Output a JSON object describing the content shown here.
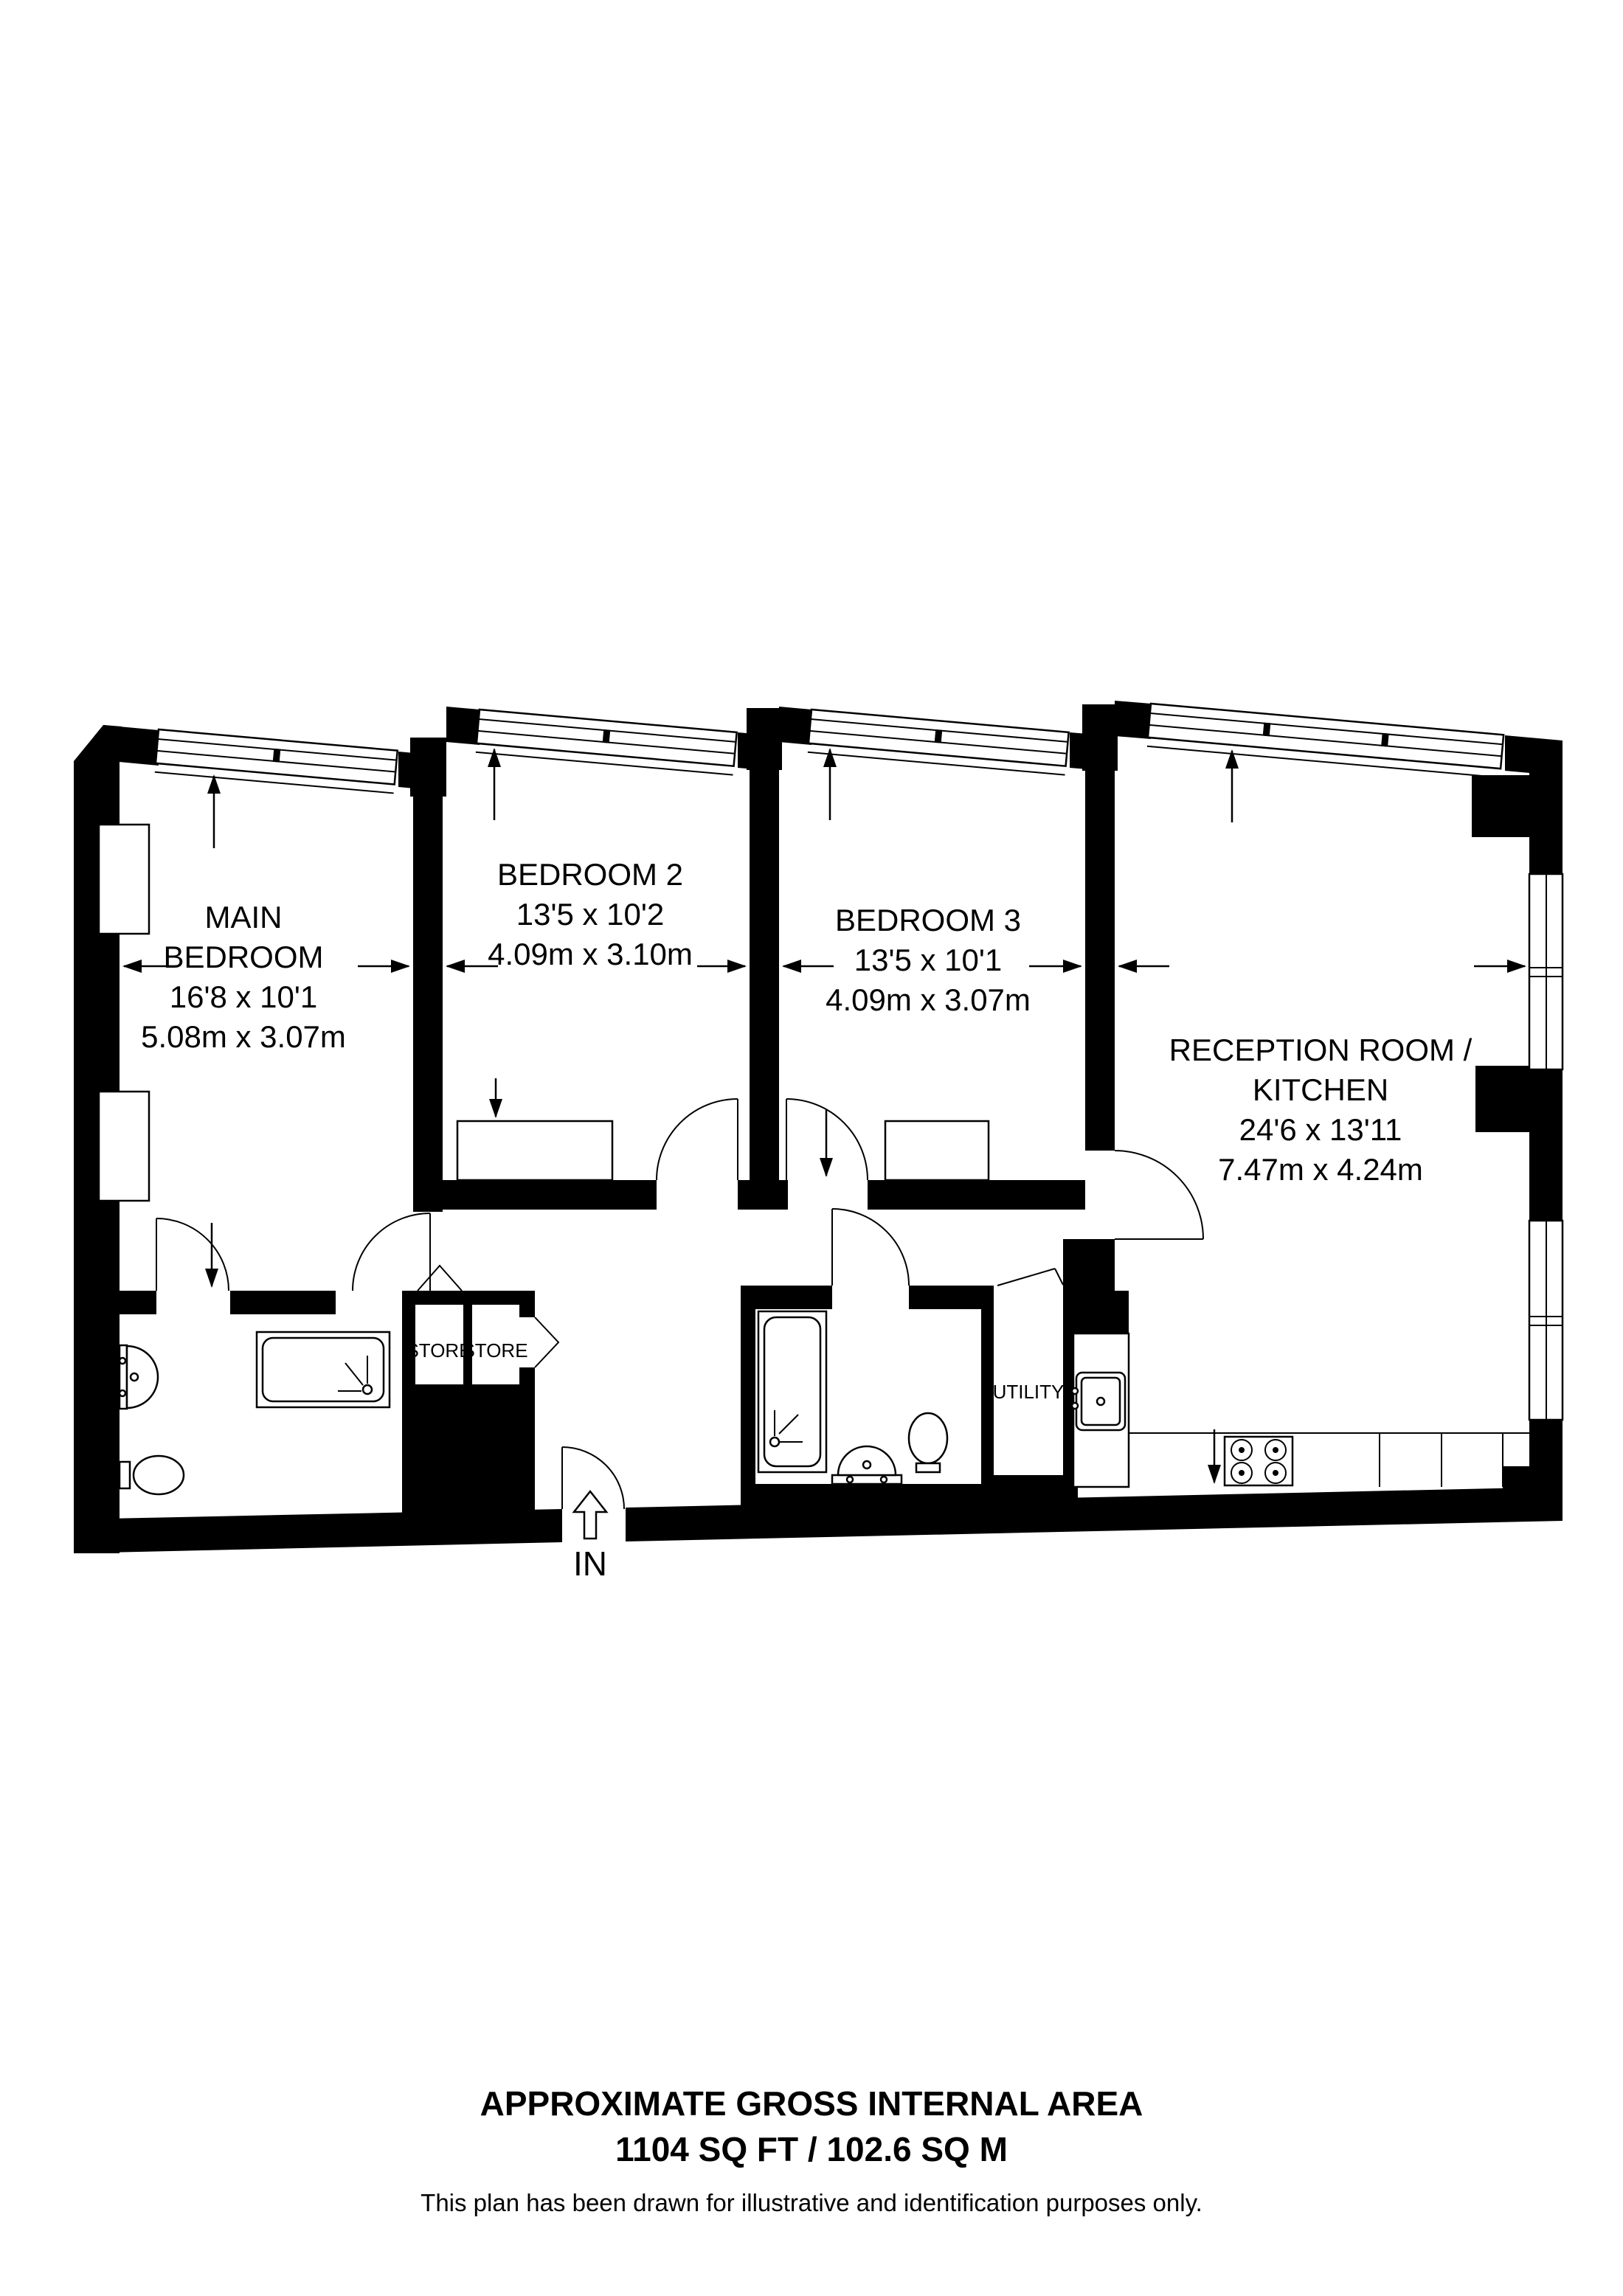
{
  "plan": {
    "rooms": [
      {
        "id": "main-bedroom",
        "lines": [
          "MAIN",
          "BEDROOM"
        ],
        "imperial": "16'8 x 10'1",
        "metric": "5.08m x 3.07m"
      },
      {
        "id": "bedroom-2",
        "lines": [
          "BEDROOM 2"
        ],
        "imperial": "13'5 x 10'2",
        "metric": "4.09m x 3.10m"
      },
      {
        "id": "bedroom-3",
        "lines": [
          "BEDROOM 3"
        ],
        "imperial": "13'5 x 10'1",
        "metric": "4.09m x 3.07m"
      },
      {
        "id": "reception-kitchen",
        "lines": [
          "RECEPTION ROOM /",
          "KITCHEN"
        ],
        "imperial": "24'6 x 13'11",
        "metric": "7.47m x 4.24m"
      }
    ],
    "closets": [
      {
        "label": "STORE"
      },
      {
        "label": "STORE"
      },
      {
        "label": "UTILITY"
      }
    ],
    "entrance_label": "IN"
  },
  "footer": {
    "title": "APPROXIMATE GROSS INTERNAL AREA",
    "area": "1104 SQ FT / 102.6 SQ M",
    "disclaimer": "This plan has been drawn for illustrative and identification purposes only."
  },
  "colors": {
    "wall": "#000000",
    "background": "#ffffff"
  }
}
